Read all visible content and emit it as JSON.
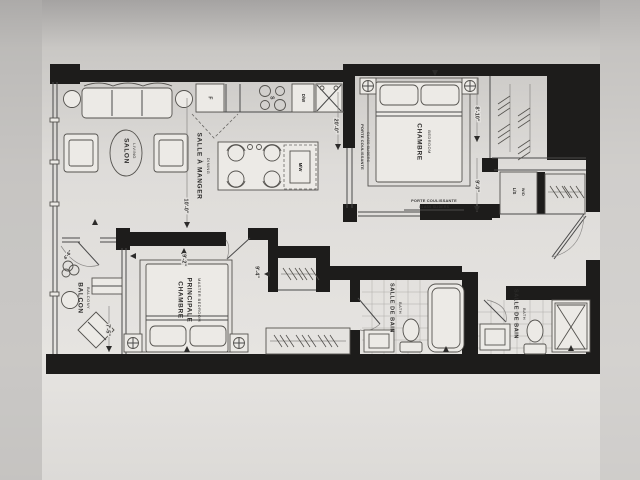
{
  "rooms": {
    "living": {
      "label": "SALON",
      "sublabel": "LIVING"
    },
    "dining": {
      "label": "SALLE À MANGER",
      "sublabel": "DINING"
    },
    "bedroom": {
      "label": "CHAMBRE",
      "sublabel": "BEDROOM"
    },
    "master": {
      "label1": "CHAMBRE",
      "label2": "PRINCIPALE",
      "sublabel": "MASTER BEDROOM"
    },
    "balcony": {
      "label": "BALCON",
      "sublabel": "BALCONY"
    },
    "bath_main": {
      "label": "SALLE DE BAIN",
      "sublabel": "BATH"
    },
    "bath_second": {
      "label": "SALLE DE BAIN",
      "sublabel": "BATH"
    }
  },
  "appliances": {
    "fridge": "F",
    "stove": "S",
    "dishwasher": "D/W",
    "microwave": "M/W",
    "laundry_top": "L/S",
    "laundry_bottom": "W/D"
  },
  "doors": {
    "slider_side": {
      "line1": "PORTE COULISSANTE",
      "line2": "GLASS SLIDERS"
    },
    "slider_bottom": {
      "line1": "PORTE COULISSANTE",
      "line2": "GLASS SLIDERS"
    }
  },
  "dimensions": {
    "kitchen_run": "20'-0\"",
    "bedroom_width": "8'-10\"",
    "bedroom_depth": "9'-0\"",
    "living_width": "10'-0\"",
    "master_width": "9'-2\"",
    "foyer": "9'-4\"",
    "balcony_depth": "7'-5\"",
    "balcony_width": "4'-6\""
  },
  "colors": {
    "wall": "#1d1c1b",
    "paper": "#e4e2df",
    "line": "#4a4a4a",
    "text": "#2c2b2a"
  }
}
